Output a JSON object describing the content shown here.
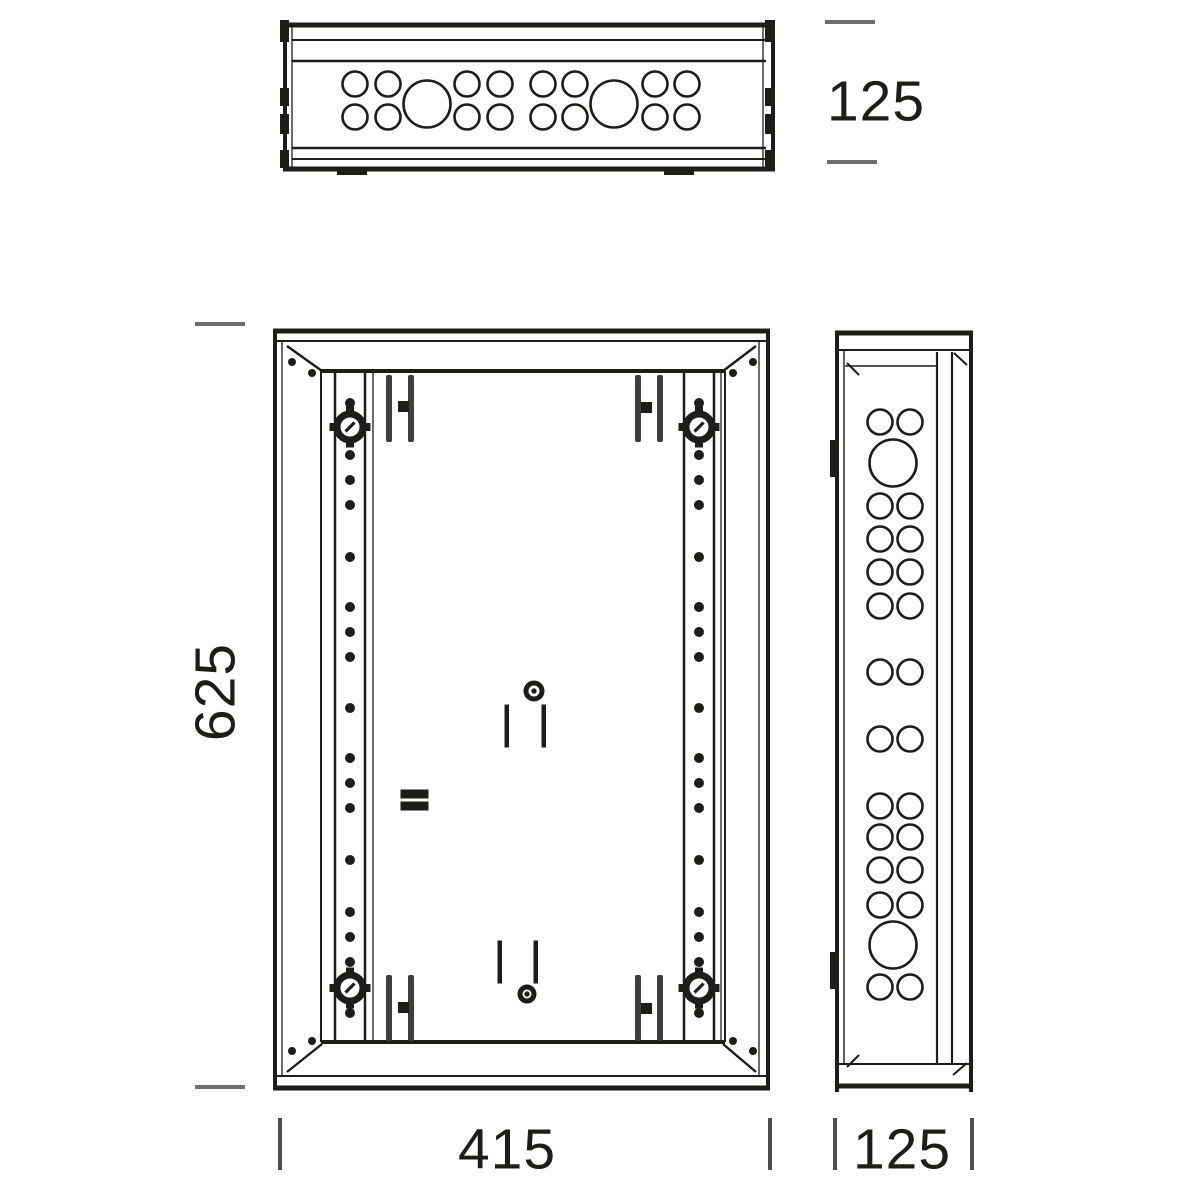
{
  "dimensions": {
    "top_depth": "125",
    "height": "625",
    "width": "415",
    "side_depth": "125"
  },
  "colors": {
    "line": "#1d1d1b",
    "bracket": "#3e3e3e",
    "tick_horizontal": "#6e6e6e",
    "tick_vertical": "#4f4f4f"
  },
  "geometry": {
    "top_view": {
      "small_cols_x": [
        355,
        388,
        467,
        500,
        543,
        575,
        655,
        687
      ],
      "small_rows_y": [
        84,
        117
      ],
      "small_r": 12.5,
      "large_x": [
        427,
        614
      ],
      "large_y": 104,
      "large_r": 23.5,
      "edge_block_rows": [
        [
          20,
          22
        ],
        [
          88,
          18
        ],
        [
          114,
          20
        ],
        [
          150,
          18
        ]
      ],
      "bottom_tabs_x": [
        337,
        664
      ]
    },
    "side_view": {
      "pair_cols_x": [
        880,
        910
      ],
      "pair_rows_y": [
        422,
        506,
        539,
        572,
        606,
        672,
        739,
        806,
        837,
        870,
        905,
        987
      ],
      "small_r": 12.5,
      "large_holes": [
        {
          "cx": 893,
          "cy": 463,
          "r": 23.5
        },
        {
          "cx": 893,
          "cy": 945,
          "r": 23.5
        }
      ],
      "notches_y": [
        440,
        952
      ]
    },
    "front_view": {
      "rail_x": [
        350,
        699
      ],
      "dot_y": [
        403,
        455,
        480,
        505,
        557,
        607,
        632,
        657,
        708,
        758,
        783,
        808,
        860,
        912,
        937,
        962,
        1013
      ],
      "dot_r": 4.5,
      "lock_y": [
        427,
        988
      ],
      "corner_dots": [
        [
          292,
          362
        ],
        [
          312,
          373
        ],
        [
          753,
          362
        ],
        [
          733,
          373
        ],
        [
          292,
          1051
        ],
        [
          312,
          1041
        ],
        [
          753,
          1051
        ],
        [
          733,
          1041
        ]
      ],
      "brackets": [
        {
          "bars_x": [
            386,
            408
          ],
          "y": 375,
          "h": 67,
          "square": [
            398,
            401
          ]
        },
        {
          "bars_x": [
            635,
            657
          ],
          "y": 375,
          "h": 67,
          "square": [
            641,
            402
          ]
        },
        {
          "bars_x": [
            386,
            408
          ],
          "y": 975,
          "h": 66,
          "square": [
            398,
            1002
          ]
        },
        {
          "bars_x": [
            635,
            657
          ],
          "y": 975,
          "h": 66,
          "square": [
            641,
            1003
          ]
        }
      ],
      "slots": [
        [
          505,
          705
        ],
        [
          542,
          705
        ],
        [
          498,
          941
        ],
        [
          534,
          941
        ]
      ],
      "slot_h": 42,
      "screws": [
        {
          "cx": 534,
          "cy": 691,
          "r": 8
        },
        {
          "cx": 527,
          "cy": 994,
          "r": 7
        }
      ],
      "equal_mark": {
        "x": 401,
        "y": 790,
        "w": 27,
        "h": 8,
        "gap": 4
      }
    }
  }
}
